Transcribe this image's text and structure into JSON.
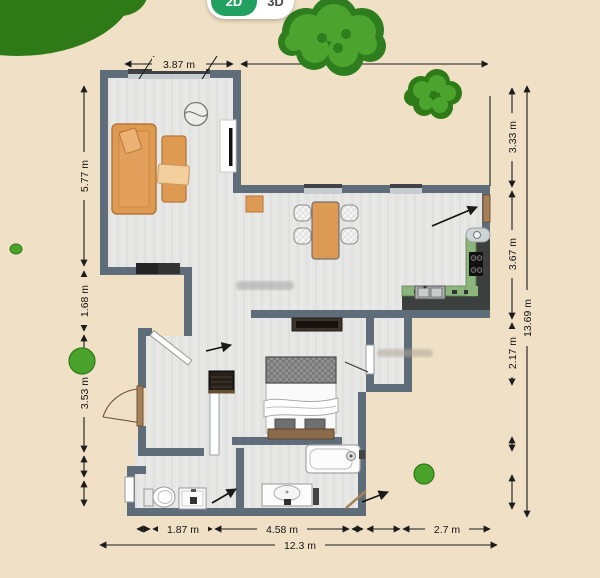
{
  "view_toggle": {
    "label_2d": "2D",
    "label_3d": "3D",
    "active": "2D"
  },
  "dimensions": {
    "top": "3.87 m",
    "left": [
      "5.77 m",
      "1.68 m",
      "3.53 m"
    ],
    "right": [
      "3.33 m",
      "3.67 m",
      "2.17 m"
    ],
    "right_total": "13.69 m",
    "bottom": [
      "1.87 m",
      "4.58 m",
      "2.7 m"
    ],
    "bottom_total": "12.3 m"
  },
  "colors": {
    "background": "#f0e1c6",
    "wall": "#5e6d79",
    "floor": "#e6e6e5",
    "furniture_orange": "#df9a52",
    "counter_green": "#8cb57c",
    "tree_dark": "#2d7a17",
    "tree_light": "#4ca42e",
    "toggle_green": "#22a060",
    "dimension_text": "#141414"
  }
}
